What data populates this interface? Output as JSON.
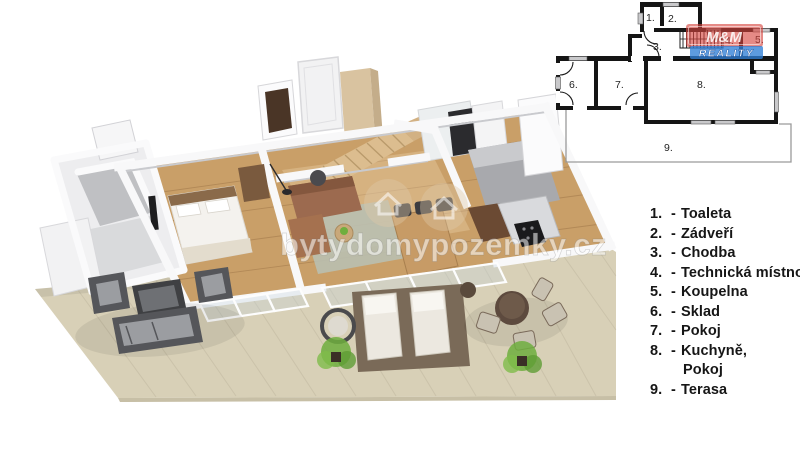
{
  "watermark": {
    "text": "bytydomypozemky.cz"
  },
  "brand": {
    "line1": "M&M",
    "line2": "REALITY",
    "red": "#d5423c",
    "blue": "#2f7fd6"
  },
  "plan2d": {
    "rooms": [
      {
        "n": "1."
      },
      {
        "n": "2."
      },
      {
        "n": "3."
      },
      {
        "n": "4."
      },
      {
        "n": "5."
      },
      {
        "n": "6."
      },
      {
        "n": "7."
      },
      {
        "n": "8."
      },
      {
        "n": "9."
      }
    ]
  },
  "legend": {
    "sep": "-",
    "items": [
      {
        "n": "1.",
        "name": "Toaleta"
      },
      {
        "n": "2.",
        "name": "Zádveří"
      },
      {
        "n": "3.",
        "name": "Chodba"
      },
      {
        "n": "4.",
        "name": "Technická místnost"
      },
      {
        "n": "5.",
        "name": "Koupelna"
      },
      {
        "n": "6.",
        "name": "Sklad"
      },
      {
        "n": "7.",
        "name": "Pokoj"
      },
      {
        "n": "8.",
        "name": "Kuchyně,",
        "name2": "Pokoj"
      },
      {
        "n": "9.",
        "name": "Terasa"
      }
    ]
  },
  "colors": {
    "wood_floor": "#c99f68",
    "stairs_wood": "#dcbd8f",
    "terrace": "#d8d0b7",
    "wall_white": "#f6f6f7",
    "storage_floor": "#bfc0c3",
    "sofa_brown": "#9c6a4f",
    "outdoor_gray": "#55565a",
    "plant_green": "#6fae3e"
  }
}
